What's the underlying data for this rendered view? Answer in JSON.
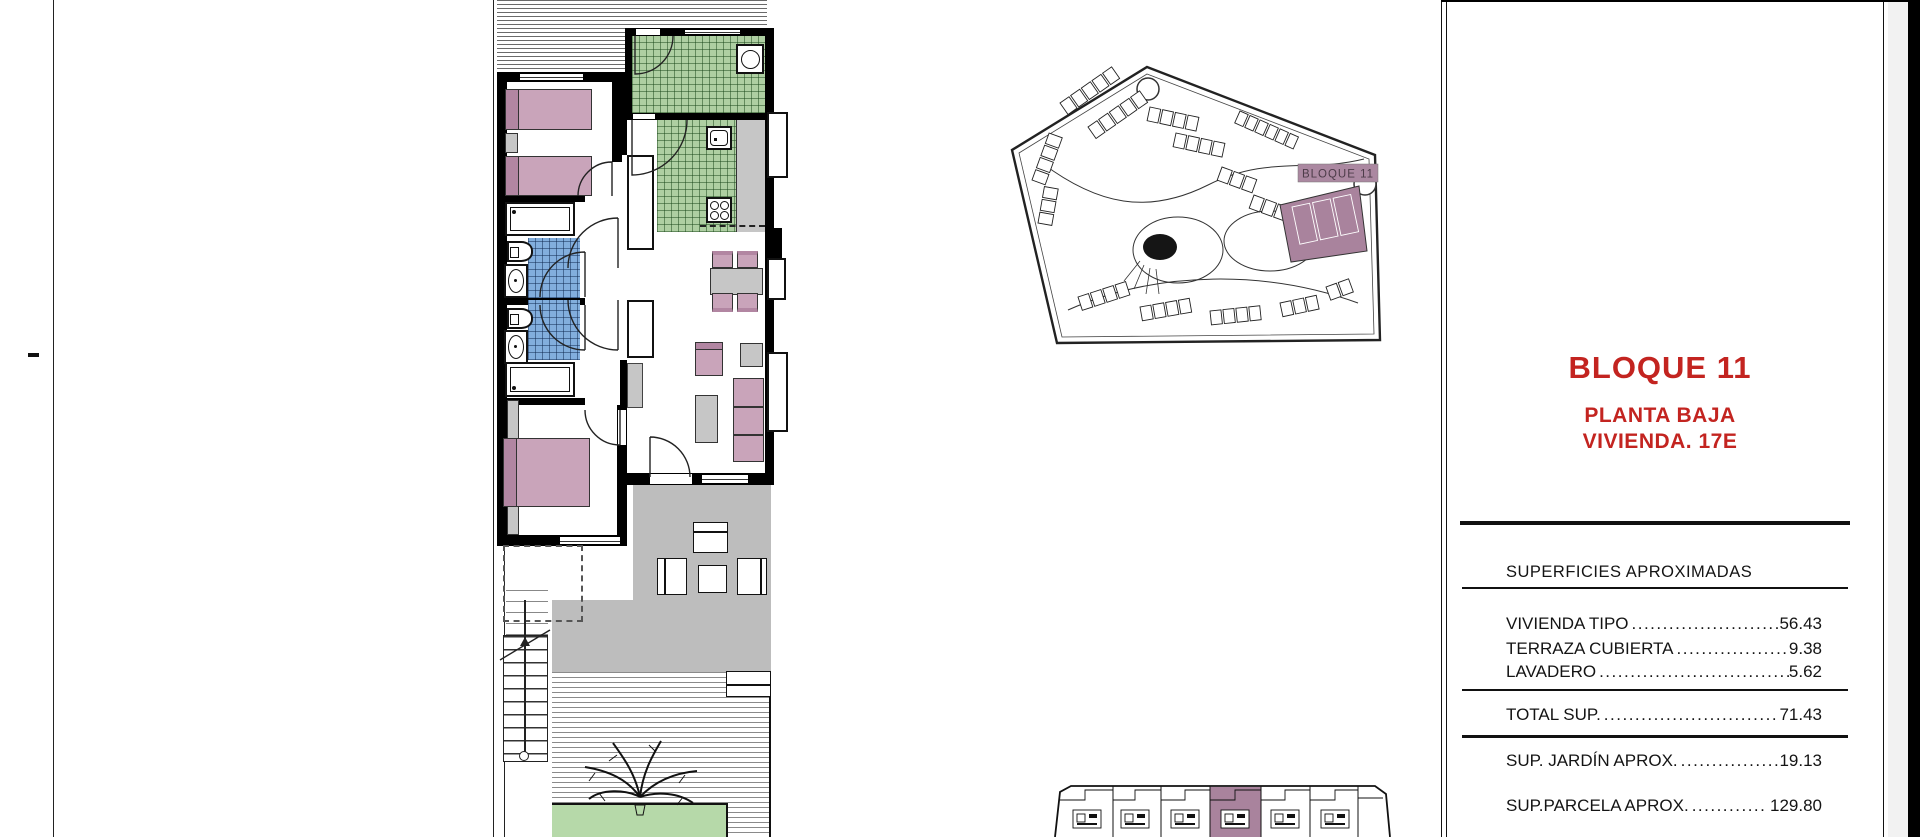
{
  "document": {
    "title": "BLOQUE 11",
    "floor_line1": "PLANTA BAJA",
    "floor_line2": "VIVIENDA. 17E"
  },
  "surfaces": {
    "heading": "SUPERFICIES APROXIMADAS",
    "rows": [
      {
        "label": "VIVIENDA TIPO",
        "dots": "..........................",
        "value": "56.43"
      },
      {
        "label": "TERRAZA CUBIERTA",
        "dots": "...................",
        "value": "9.38"
      },
      {
        "label": "LAVADERO",
        "dots": ".....................................",
        "value": "5.62"
      }
    ],
    "total": {
      "label": "TOTAL SUP.",
      "dots": "................................",
      "value": "71.43"
    },
    "garden": {
      "label": "SUP. JARDÍN APROX.",
      "dots": "................",
      "value": "19.13"
    },
    "parcel": {
      "label": "SUP.PARCELA APROX.",
      "dots": "............",
      "value": "129.80"
    }
  },
  "site_plan": {
    "block_label": "BLOQUE 11"
  },
  "colors": {
    "accent_red": "#c32420",
    "plan_mauve": "#a9839d",
    "label_mauve": "#ab88a1",
    "tile_green": "#aecfa2",
    "tile_blue": "#82aedd",
    "furn_pink": "#c9a4ba",
    "furn_pink_dark": "#b286a2",
    "furn_gray": "#c6c6c6",
    "terrace_gray": "#bdbdbd",
    "garden_green": "#b6d9a9",
    "wall": "#000000"
  }
}
